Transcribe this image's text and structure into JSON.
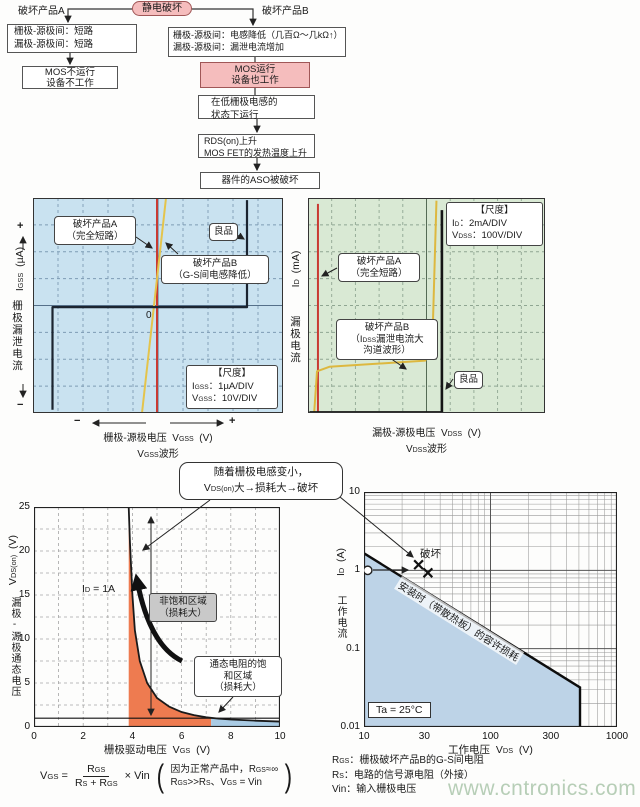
{
  "flowchart": {
    "branch_a_label": "破坏产品A",
    "root": "静电破坏",
    "branch_b_label": "破坏产品B",
    "box_a1": [
      "栅极-源极间：短路",
      "漏极-源极间：短路"
    ],
    "box_b1": [
      "栅极-源极间：电感降低（几百Ω～几kΩ↑）",
      "漏极-源极间：漏泄电流增加"
    ],
    "box_a2": [
      "MOS不运行",
      "设备不工作"
    ],
    "box_b2": [
      "MOS运行",
      "设备也工作"
    ],
    "box_b3": [
      "在低栅极电感的",
      "状态下运行"
    ],
    "box_b4": [
      "RDS(on)上升",
      "MOS FET的发热温度上升"
    ],
    "box_b5": "器件的ASO被破坏"
  },
  "bubble": {
    "line1": "随着栅极电感变小，",
    "line2": "V_{DS(on)}大→损耗大→破坏"
  },
  "chart_data": [
    {
      "id": "gate_leakage_scope",
      "type": "line",
      "bg_color": "#c9e2f0",
      "title_wave": "V_{GSS}波形",
      "xlabel": "栅极-源极电压  V_{GSS}  (V)",
      "ylabel_cjk": "栅极漏泄电流",
      "ylabel_sym": "I_{GSS}  (µA)",
      "axis_plus": "+",
      "axis_minus": "−",
      "zero_label": "0",
      "scale_box": {
        "heading": "【尺度】",
        "lines": [
          "I_{GSS}：1µA/DIV",
          "V_{GSS}：10V/DIV"
        ]
      },
      "grid": {
        "cols": 10,
        "rows": 8,
        "style": "dashed"
      },
      "series": [
        {
          "name": "破坏产品A（完全短路）",
          "color": "#c93a32",
          "width": 2,
          "points_div": [
            [
              4.96,
              0
            ],
            [
              4.96,
              8
            ]
          ]
        },
        {
          "name": "破坏产品B（G-S间电感降低）",
          "color": "#e4c44c",
          "width": 2,
          "points_div": [
            [
              4.36,
              0
            ],
            [
              5.32,
              8
            ]
          ]
        },
        {
          "name": "良品",
          "color": "#1b2430",
          "width": 2.2,
          "points_div": [
            [
              0.78,
              0.12
            ],
            [
              0.78,
              3.94
            ],
            [
              8.56,
              3.94
            ],
            [
              8.56,
              7.92
            ]
          ]
        }
      ],
      "callouts": {
        "a": [
          "破坏产品A",
          "（完全短路）"
        ],
        "b": [
          "破坏产品B",
          "（G-S间电感降低）"
        ],
        "good": "良品"
      }
    },
    {
      "id": "drain_leakage_scope",
      "type": "line",
      "bg_color": "#d9e9d4",
      "title_wave": "V_{DSS}波形",
      "xlabel": "漏极-源极电压  V_{DSS}  (V)",
      "ylabel_cjk": "漏极电流",
      "ylabel_sym": "I_{D}  (mA)",
      "scale_box": {
        "heading": "【尺度】",
        "lines": [
          "I_{D}：2mA/DIV",
          "V_{DSS}：100V/DIV"
        ]
      },
      "grid": {
        "cols": 10,
        "rows": 8,
        "style": "dashed"
      },
      "series": [
        {
          "name": "破坏产品A（完全短路）",
          "color": "#c93a32",
          "width": 2,
          "points_div": [
            [
              0.42,
              0
            ],
            [
              0.42,
              7.78
            ]
          ]
        },
        {
          "name": "破坏产品B（IDSS漏泄电流大 沟道波形）",
          "color": "#ddb83f",
          "width": 2,
          "points_div": [
            [
              0.26,
              0
            ],
            [
              0.38,
              1.55
            ],
            [
              0.9,
              1.72
            ],
            [
              4.95,
              1.95
            ],
            [
              5.25,
              2.7
            ],
            [
              5.42,
              7.9
            ]
          ]
        },
        {
          "name": "良品",
          "color": "#151515",
          "width": 2.6,
          "points_div": [
            [
              0.06,
              0.02
            ],
            [
              5.65,
              0.02
            ],
            [
              5.65,
              7.55
            ]
          ]
        }
      ],
      "callouts": {
        "a": [
          "破坏产品A",
          "（完全短路）"
        ],
        "b": [
          "破坏产品B",
          "（I_{DSS}漏泄电流大",
          "沟道波形）"
        ],
        "good": "良品"
      }
    },
    {
      "id": "vdson_vs_vgs",
      "type": "line",
      "xlabel": "栅极驱动电压  V_{GS}  (V)",
      "ylabel_cjk": "漏极-源极通态电压",
      "ylabel_sym": "V_{DS(on)}  (V)",
      "xlim": [
        0,
        10
      ],
      "ylim": [
        0,
        25
      ],
      "xticks": [
        0,
        2,
        4,
        6,
        8,
        10
      ],
      "yticks": [
        0,
        5,
        10,
        15,
        20,
        25
      ],
      "curve_label": "I_{D} = 1A",
      "curve": [
        [
          3.85,
          25
        ],
        [
          3.9,
          21
        ],
        [
          4.0,
          15
        ],
        [
          4.1,
          11
        ],
        [
          4.3,
          7.5
        ],
        [
          4.6,
          5
        ],
        [
          5.0,
          3.3
        ],
        [
          5.5,
          2.3
        ],
        [
          6.0,
          1.7
        ],
        [
          6.5,
          1.35
        ],
        [
          7.0,
          1.1
        ],
        [
          7.5,
          0.95
        ],
        [
          8,
          0.85
        ],
        [
          9,
          0.72
        ],
        [
          10,
          0.62
        ]
      ],
      "ref_line_y": 1,
      "regions": [
        {
          "label": [
            "非饱和区域",
            "（损耗大）"
          ],
          "x_range": [
            3.85,
            7.2
          ],
          "color": "#ee7b50"
        },
        {
          "label": [
            "通态电阻的饱",
            "和区域",
            "（损耗大）"
          ],
          "x_range": [
            7.2,
            10
          ],
          "color": "#a9cbe4"
        }
      ]
    },
    {
      "id": "aso_power",
      "type": "line",
      "scale": "log-log",
      "xlabel": "工作电压  V_{DS}  (V)",
      "ylabel_cjk": "工作电流",
      "ylabel_sym": "I_{D}  (A)",
      "xlim": [
        10,
        1000
      ],
      "ylim": [
        0.01,
        10
      ],
      "xticks": [
        10,
        30,
        100,
        300,
        1000
      ],
      "yticks": [
        "10",
        "1",
        "0.1",
        "0.01"
      ],
      "line_label": "安装时（带散热板）的容许损耗",
      "aso_line": [
        [
          10,
          1.65
        ],
        [
          510,
          0.032
        ],
        [
          510,
          0.01
        ]
      ],
      "fill_color": "#bdd3e7",
      "markers": [
        {
          "type": "circle",
          "v": 10.7,
          "i": 1.0
        },
        {
          "type": "x",
          "v": 27,
          "i": 1.18
        },
        {
          "type": "x",
          "v": 32,
          "i": 0.93
        }
      ],
      "damage_label": "破坏",
      "temp_label": "Ta = 25°C"
    }
  ],
  "formula": {
    "lhs": "V_{GS} =",
    "numerator": "R_{GS}",
    "denominator": "R_{S} + R_{GS}",
    "multiplier": "× Vin",
    "note_line1": "因为正常产品中，R_{GS}≈∞",
    "note_line2": "R_{GS}>>R_{S}、V_{GS} = Vin"
  },
  "legend": {
    "lines": [
      "R_{GS}：栅极破坏产品B的G-S间电阻",
      "R_{S}：电路的信号源电阻（外接）",
      "Vin：输入栅极电压"
    ]
  },
  "watermark": "www.cntronics.com"
}
